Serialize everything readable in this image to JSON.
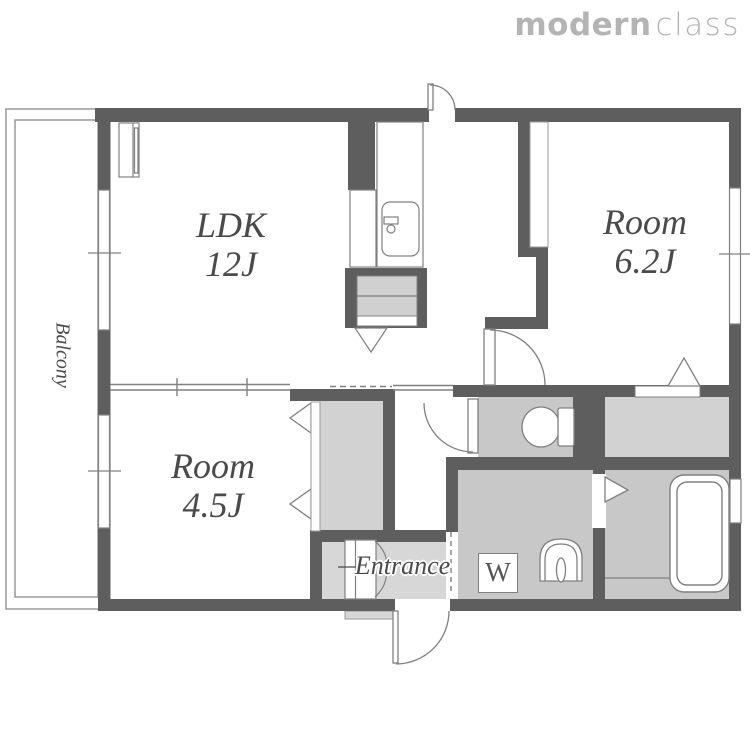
{
  "logo": {
    "bold": "modern",
    "light": "class"
  },
  "rooms": {
    "ldk": {
      "name": "LDK",
      "size": "12J"
    },
    "room62": {
      "name": "Room",
      "size": "6.2J"
    },
    "room45": {
      "name": "Room",
      "size": "4.5J"
    },
    "balcony": {
      "label": "Balcony"
    },
    "entrance": {
      "label": "Entrance"
    },
    "washer": {
      "label": "W"
    }
  },
  "icons": {
    "toilet": "toilet-icon",
    "bathtub": "bathtub-icon",
    "washbasin": "washbasin-icon",
    "kitchen_sink": "kitchen-sink-icon",
    "refrigerator": "refrigerator-icon",
    "range_hood": "range-hood-triangle-icon",
    "doors": "door-swing-arc",
    "windows": "window-strip"
  },
  "colors": {
    "wall": "#5e5e5e",
    "line": "#808080",
    "thin": "#9a9a9a",
    "floor": "#c8c8c8",
    "closet": "#d2d2d2",
    "entrance": "#d7d7d7",
    "counter": "#d0d0d0",
    "text": "#4a4a4a",
    "logo": "#b4b4b4"
  }
}
